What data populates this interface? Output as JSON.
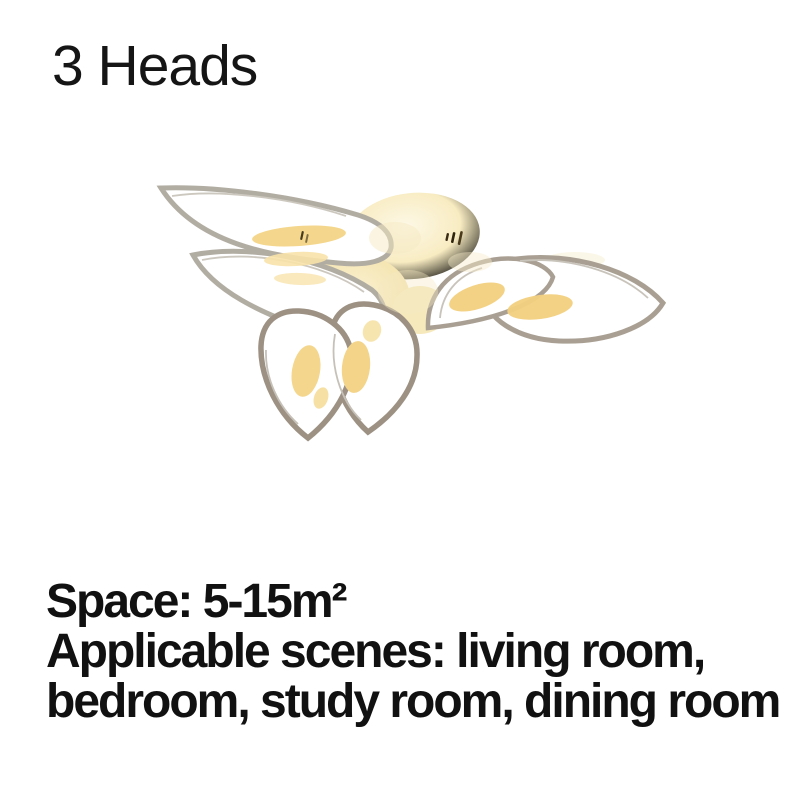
{
  "header": {
    "title": "3 Heads"
  },
  "specs": {
    "space_line": "Space: 5-15m²",
    "scenes_line_1": "Applicable scenes: living room,",
    "scenes_line_2": "bedroom, study room, dining room"
  },
  "colors": {
    "background": "#ffffff",
    "text": "#111111",
    "petal_outline_light": "#b2ada3",
    "petal_outline_mid": "#a9a093",
    "petal_outline_dark": "#9c9183",
    "led_glow": "#f3d286",
    "canopy_cream": "#f5e4ae"
  }
}
